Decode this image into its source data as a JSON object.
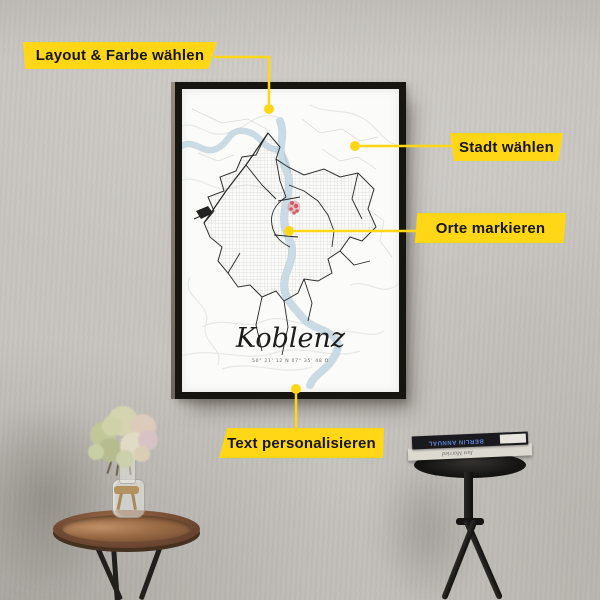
{
  "callouts": [
    {
      "id": "layout",
      "label": "Layout & Farbe wählen"
    },
    {
      "id": "stadt",
      "label": "Stadt wählen"
    },
    {
      "id": "orte",
      "label": "Orte markieren"
    },
    {
      "id": "text",
      "label": "Text personalisieren"
    }
  ],
  "poster": {
    "title": "Koblenz",
    "coordinates": "50° 21' 12 N 07° 35' 48 O"
  },
  "props": {
    "books": [
      {
        "spine": "BERLIN ANNUAL"
      },
      {
        "spine": "Just Married"
      }
    ]
  },
  "colors": {
    "callout_yellow": "#FFD717",
    "marker_red": "#CF5F66",
    "river_blue": "#C8DAE4",
    "frame_black": "#17150F",
    "wall_gray": "#C6C3BE",
    "poster_white": "#FBFBF9"
  }
}
